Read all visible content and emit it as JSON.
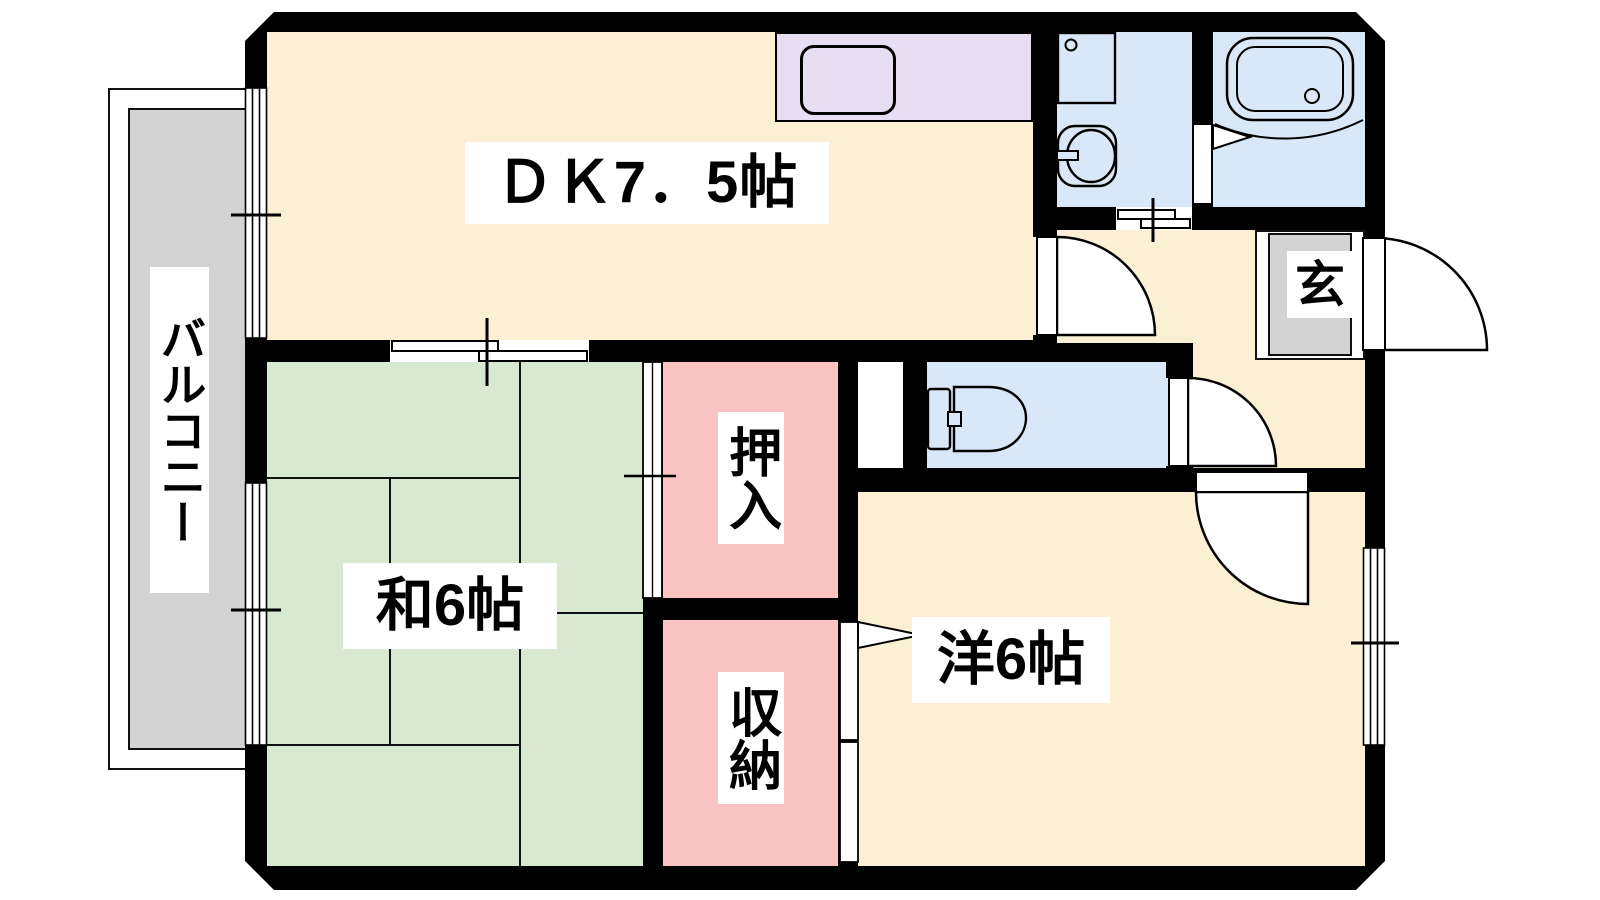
{
  "plan": {
    "type": "floor-plan",
    "rooms": {
      "dk": {
        "label": "ＤＫ7．5帖"
      },
      "japanese_room": {
        "label": "和6帖"
      },
      "western_room": {
        "label": "洋6帖"
      },
      "closet_oshiire": {
        "label": "押入"
      },
      "closet_shuno": {
        "label": "収納"
      },
      "balcony": {
        "label": "バルコニー"
      },
      "entrance": {
        "label": "玄"
      }
    },
    "fixtures": [
      "kitchen-sink",
      "washing-machine-pan",
      "washbasin",
      "bathtub",
      "toilet",
      "hinged-door",
      "sliding-door",
      "window"
    ]
  },
  "colors": {
    "wall": "#000000",
    "cream": "#FBF0D3",
    "green": "#D9E8D0",
    "pink": "#FAC4C3",
    "blue": "#D9E8F8",
    "lavender": "#E7DEF1",
    "gray": "#D3D3D3"
  }
}
